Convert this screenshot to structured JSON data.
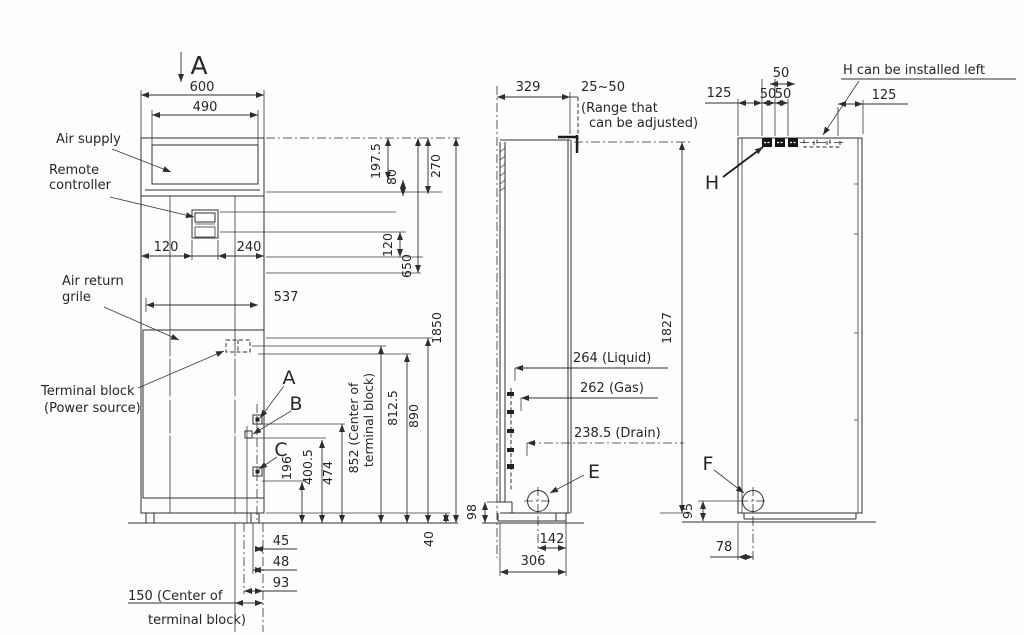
{
  "front": {
    "section_label": "A",
    "dim_width": "600",
    "dim_supply_width": "490",
    "label_air_supply": "Air supply",
    "label_remote_1": "Remote",
    "label_remote_2": "controller",
    "label_return_1": "Air return",
    "label_return_2": "grile",
    "label_terminal_1": "Terminal block",
    "label_terminal_2": "(Power source)",
    "dim_120_left": "120",
    "dim_240": "240",
    "dim_537": "537",
    "callout_a": "A",
    "callout_b": "B",
    "callout_c": "C",
    "dim_197_5": "197.5",
    "dim_80": "80",
    "dim_270": "270",
    "dim_120_right": "120",
    "dim_650": "650",
    "dim_1850": "1850",
    "dim_196": "196",
    "dim_400_5": "400.5",
    "dim_474": "474",
    "dim_852_1": "852 (Center of",
    "dim_852_2": "terminal block)",
    "dim_812_5": "812.5",
    "dim_890": "890",
    "dim_45": "45",
    "dim_48": "48",
    "dim_93": "93",
    "dim_40": "40",
    "dim_150_1": "150 (Center of",
    "dim_150_2": "terminal block)"
  },
  "side": {
    "dim_329": "329",
    "dim_25_50": "25~50",
    "range_note_1": "(Range that",
    "range_note_2": "can be adjusted)",
    "dim_liquid": "264 (Liquid)",
    "dim_gas": "262 (Gas)",
    "dim_drain": "238.5 (Drain)",
    "callout_e": "E",
    "dim_98": "98",
    "dim_142": "142",
    "dim_306": "306",
    "dim_1827": "1827"
  },
  "rear": {
    "dim_125_left": "125",
    "dim_50_top": "50",
    "dim_50_a": "50",
    "dim_50_b": "50",
    "note_h": "H can be installed left",
    "dim_125_right": "125",
    "callout_h": "H",
    "callout_f": "F",
    "dim_95": "95",
    "dim_78": "78"
  }
}
